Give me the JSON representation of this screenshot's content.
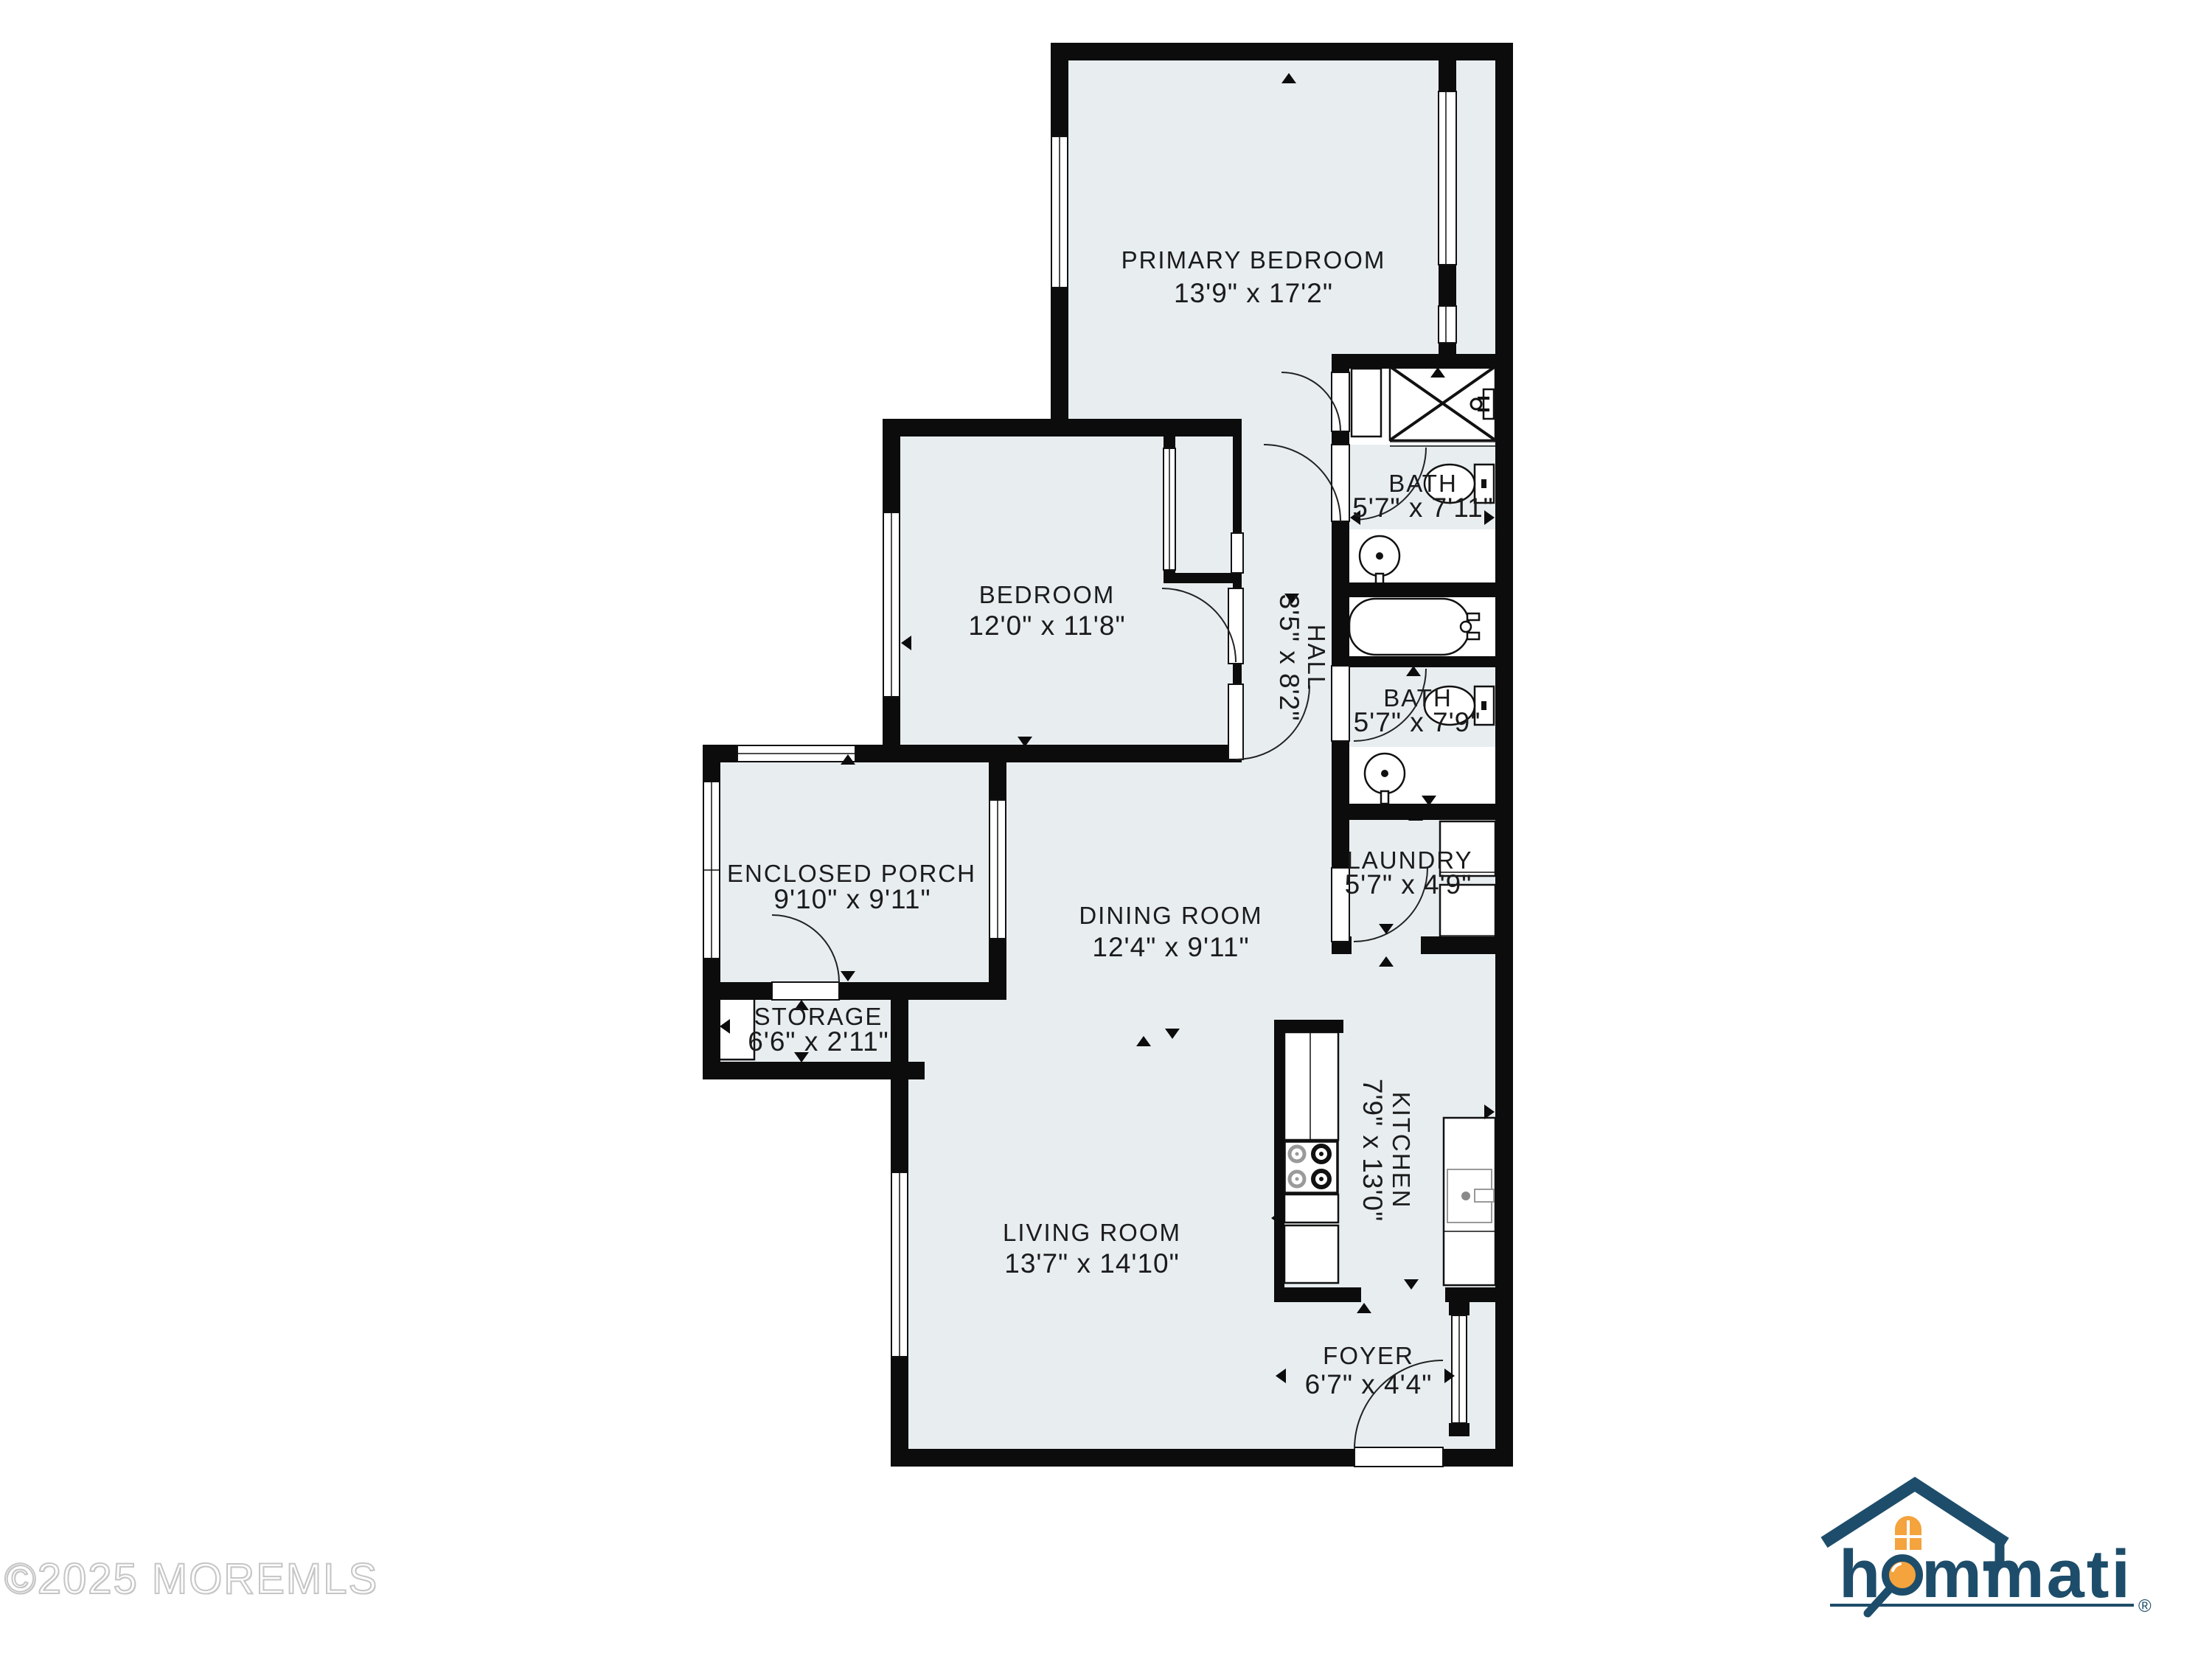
{
  "watermark": {
    "text": "©2025 MOREMLS"
  },
  "logo": {
    "brand": "hommati",
    "brand_h": "h",
    "brand_rest": "mmati",
    "registered": "®"
  },
  "rooms": [
    {
      "id": "primary-bedroom",
      "name": "PRIMARY BEDROOM",
      "dims": "13'9\" x 17'2\""
    },
    {
      "id": "bath-1",
      "name": "BATH",
      "dims": "5'7\" x 7'11\""
    },
    {
      "id": "bedroom",
      "name": "BEDROOM",
      "dims": "12'0\" x 11'8\""
    },
    {
      "id": "hall",
      "name": "HALL",
      "dims": "3'5\" x 8'2\""
    },
    {
      "id": "bath-2",
      "name": "BATH",
      "dims": "5'7\" x 7'9\""
    },
    {
      "id": "laundry",
      "name": "LAUNDRY",
      "dims": "5'7\" x 4'9\""
    },
    {
      "id": "enclosed-porch",
      "name": "ENCLOSED PORCH",
      "dims": "9'10\" x 9'11\""
    },
    {
      "id": "dining-room",
      "name": "DINING ROOM",
      "dims": "12'4\" x 9'11\""
    },
    {
      "id": "storage",
      "name": "STORAGE",
      "dims": "6'6\" x 2'11\""
    },
    {
      "id": "kitchen",
      "name": "KITCHEN",
      "dims": "7'9\" x 13'0\""
    },
    {
      "id": "living-room",
      "name": "LIVING ROOM",
      "dims": "13'7\" x 14'10\""
    },
    {
      "id": "foyer",
      "name": "FOYER",
      "dims": "6'7\" x 4'4\""
    }
  ],
  "colors": {
    "floor": "#e8edf0",
    "wall": "#0c0c0c",
    "logo_navy": "#1d4d6a",
    "logo_orange": "#f4a33d",
    "watermark_gray": "#c6c6c6"
  }
}
